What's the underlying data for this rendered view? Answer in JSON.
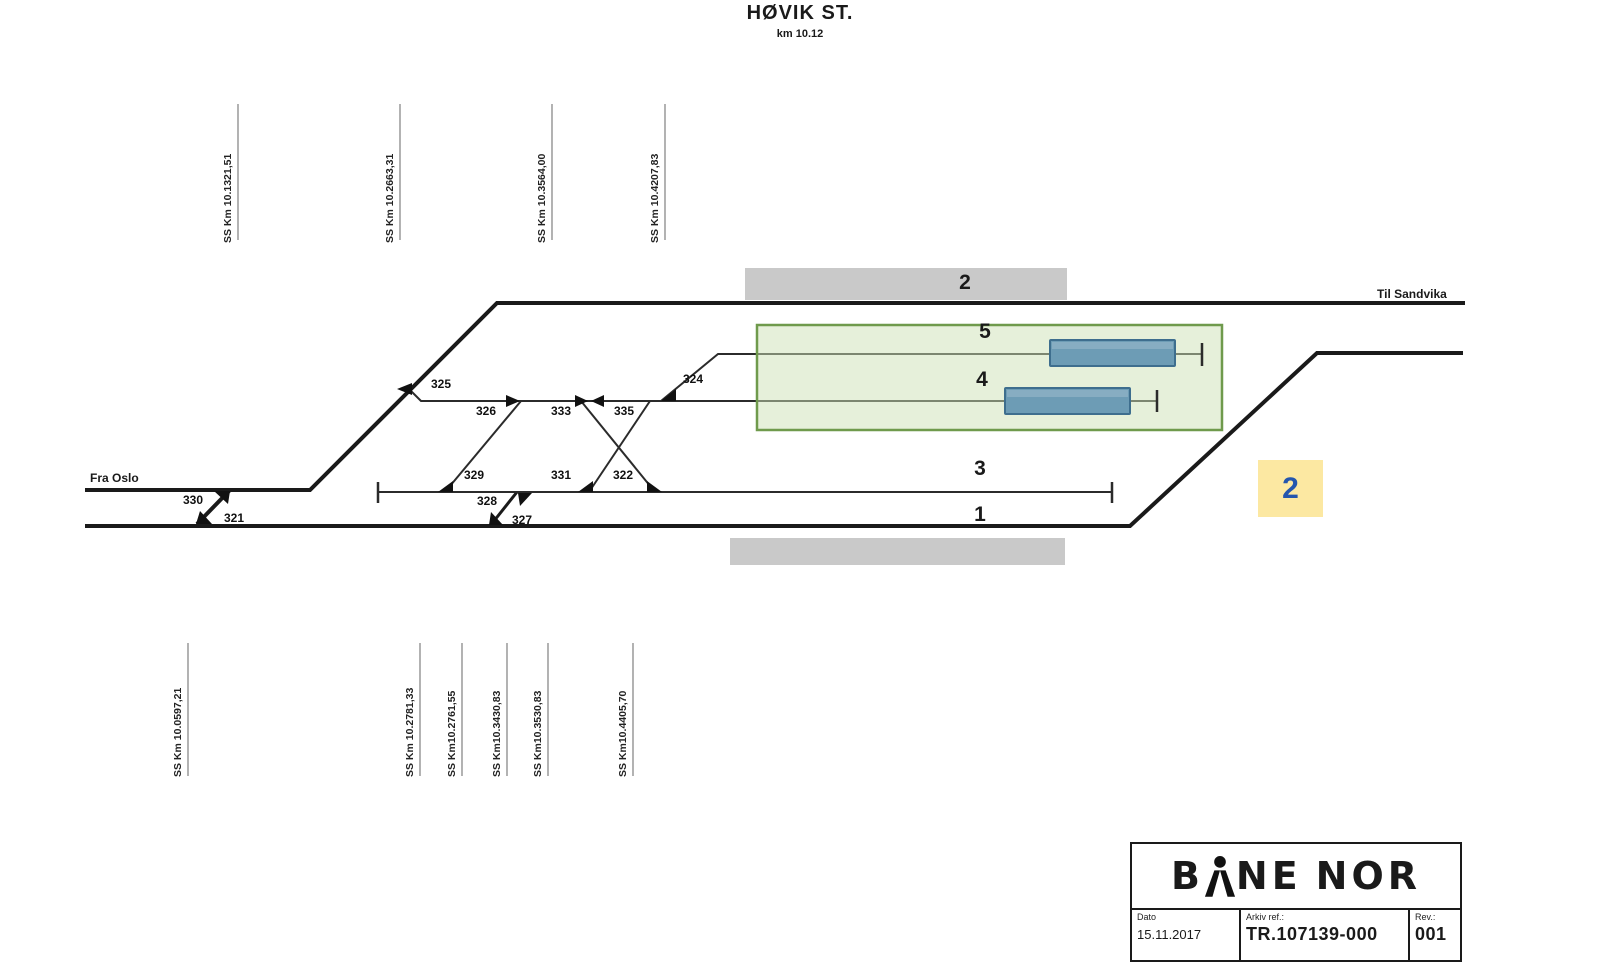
{
  "station": {
    "name": "HØVIK ST.",
    "km": "km 10.12"
  },
  "directions": {
    "from": "Fra Oslo",
    "to": "Til Sandvika"
  },
  "platform": {
    "label": "2"
  },
  "track_labels": {
    "t5": "5",
    "t4": "4",
    "t3": "3",
    "t1": "1"
  },
  "train_area": {
    "badge_label": "2"
  },
  "switches": {
    "s330": "330",
    "s321": "321",
    "s325": "325",
    "s326": "326",
    "s333": "333",
    "s335": "335",
    "s324": "324",
    "s329": "329",
    "s331": "331",
    "s322": "322",
    "s328": "328",
    "s327": "327"
  },
  "km_markers": {
    "top": [
      "SS Km 10.1321,51",
      "SS Km 10.2663,31",
      "SS Km 10.3564,00",
      "SS Km 10.4207,83"
    ],
    "bottom": [
      "SS Km 10.0597,21",
      "SS Km 10.2781,33",
      "SS Km10.2761,55",
      "SS Km10.3430,83",
      "SS Km10.3530,83",
      "SS Km10.4405,70"
    ]
  },
  "title_block": {
    "logo": {
      "left": "B",
      "mid": "NE",
      "right": "NOR"
    },
    "date_label": "Dato",
    "date": "15.11.2017",
    "ref_label": "Arkiv ref.:",
    "ref": "TR.107139-000",
    "rev_label": "Rev.:",
    "rev": "001"
  },
  "colors": {
    "track": "#1a1a1a",
    "yard_track": "#2b2b2b",
    "platform": "#c9c9c9",
    "zone_fill": "#cde2b5",
    "zone_stroke": "#6f9a4c",
    "train_fill": "#6d9cb5",
    "train_stroke": "#3e6e8e",
    "badge_bg": "#fce8a2",
    "badge_text": "#2456ae",
    "km_line": "#808080"
  }
}
